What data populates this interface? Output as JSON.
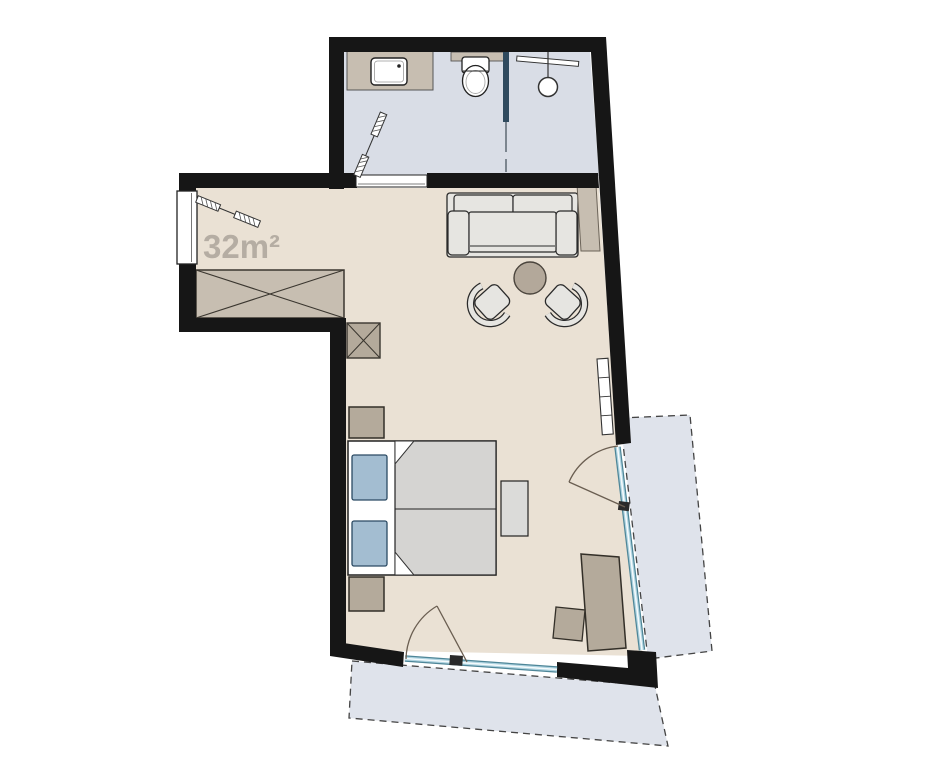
{
  "floorplan": {
    "area_label": "32m²",
    "palette": {
      "wall": "#161616",
      "floor_main": "#eae1d4",
      "floor_bath": "#d9dde6",
      "balcony": "#dfe3eb",
      "furniture_tan": "#c7beb1",
      "furniture_dark_tan": "#b4aa9b",
      "bed_blanket": "#d5d4d2",
      "pillow_blue": "#a3bdd1",
      "sofa_gray": "#e6e5e1",
      "table_round": "#b3a89a",
      "glass": "#4e8698",
      "divider_navy": "#2f4a5e",
      "label_gray": "#b5ada3",
      "outline_dark": "#2a2a2a"
    }
  }
}
